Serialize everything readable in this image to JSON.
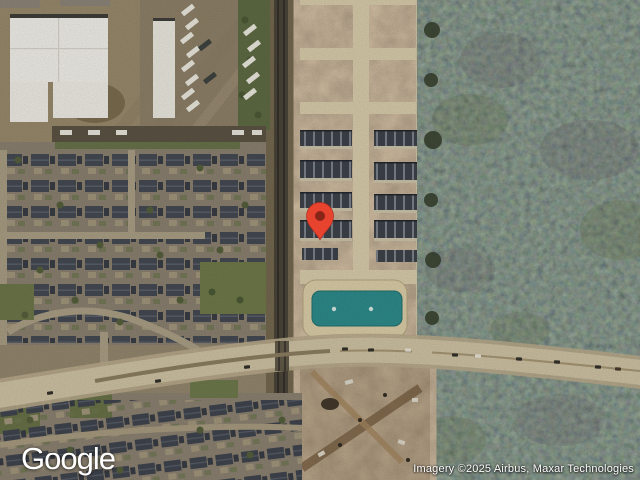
{
  "window": {
    "width": 640,
    "height": 480,
    "view_type": "satellite"
  },
  "map": {
    "marker": {
      "x": 320,
      "y": 240
    }
  },
  "logo": {
    "text": "Google"
  },
  "attribution": {
    "text": "Imagery ©2025 Airbus, Maxar Technologies"
  },
  "colors": {
    "marker_red": "#E8432F",
    "marker_dot": "#8A2419",
    "pond_water": "#2E8B8B",
    "forest_base": "#3B4334",
    "road_surface": "#CFC3A4"
  }
}
